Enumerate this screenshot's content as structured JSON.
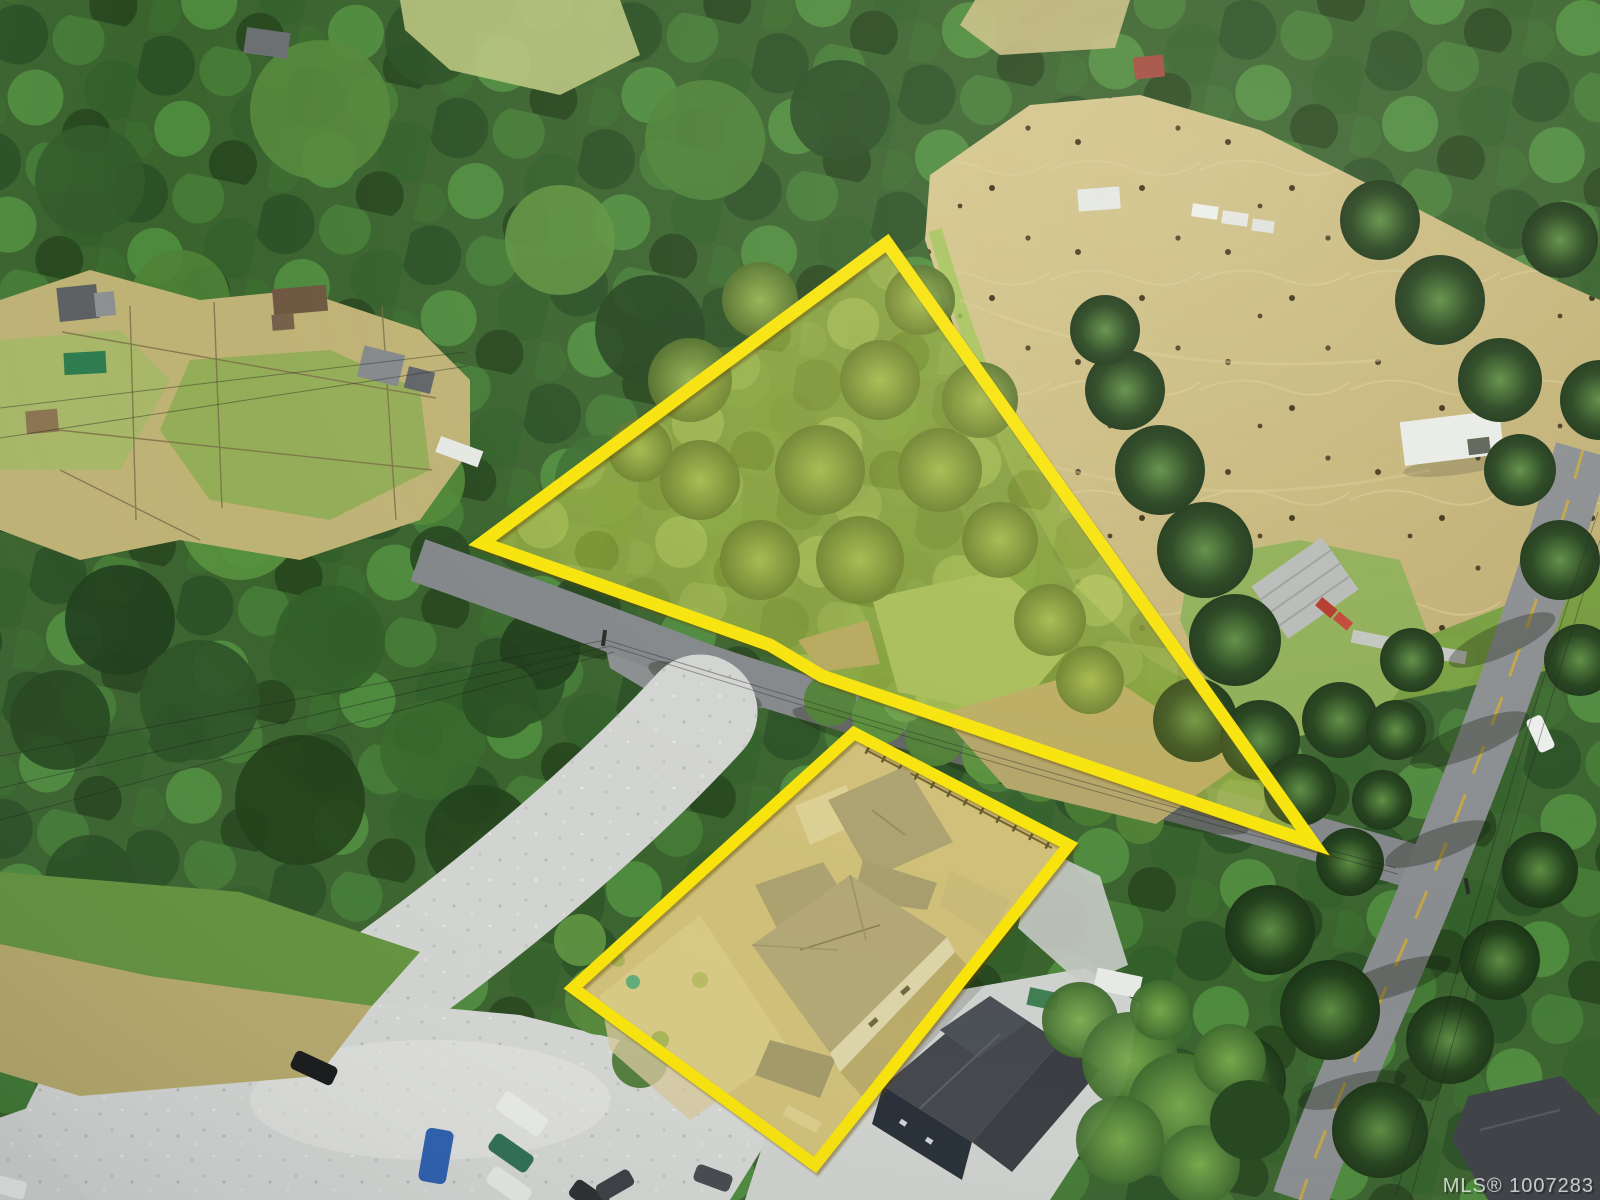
{
  "photo": {
    "kind": "aerial-drone-listing-photo",
    "watermark_text": "MLS® 1007283",
    "watermark_color": "#FFFFFF"
  },
  "overlay": {
    "boundary_color": "#F8E30A",
    "lot_tint_color": "#E8D83C",
    "parcels": [
      {
        "id": "treed-acreage-parcel",
        "shape": "triangle"
      },
      {
        "id": "new-home-lot",
        "shape": "rectangle"
      }
    ]
  },
  "palette": {
    "forest_dark": "#2B4F24",
    "forest_mid": "#3A632E",
    "canopy_light": "#7C9F44",
    "hay_field": "#CDBD82",
    "gravel": "#D3D5D2",
    "asphalt": "#8A8D90",
    "road_centerline": "#C9A83A",
    "new_construction_roof": "#A39A86",
    "neighbor_roof_dark": "#42464B"
  }
}
